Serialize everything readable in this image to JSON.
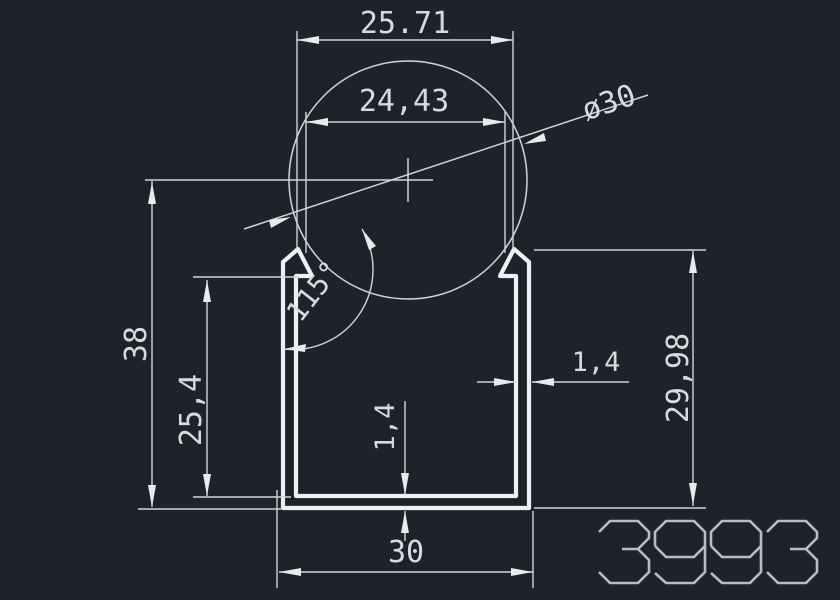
{
  "drawing": {
    "title": "extrusion-profile-drawing",
    "background": "#1e232b",
    "line_color": "#d4d8db",
    "profile_color": "#eef0f2",
    "text_color": "#d8dbde",
    "part_number_color": "#b8bdc4",
    "part_number": "3993",
    "dimensions": {
      "top_outer_width": "25.71",
      "top_inner_width": "24,43",
      "diameter": "ø30",
      "overall_height": "38",
      "inner_height": "25,4",
      "lip_angle": "115°",
      "wall_thickness": "1,4",
      "bottom_thickness": "1,4",
      "right_height": "29,98",
      "bottom_width": "30"
    }
  }
}
